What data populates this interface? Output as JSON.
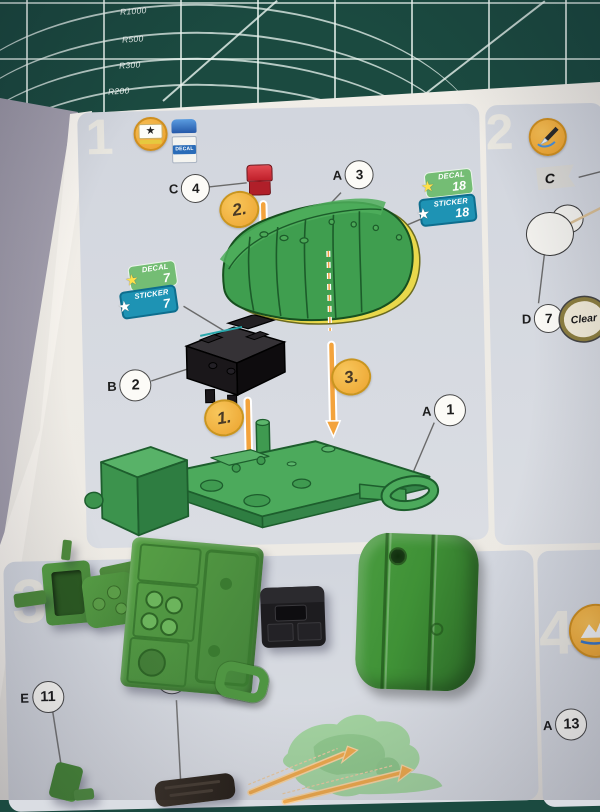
{
  "mat": {
    "labels": [
      "R1000",
      "R500",
      "R300",
      "R200"
    ]
  },
  "icons": {
    "star": "★"
  },
  "panels": {
    "p1": "1",
    "p2": "2",
    "p3": "3",
    "p4": "4"
  },
  "step1": {
    "bottle_label": "DECAL"
  },
  "step2": {
    "flag_label": "C",
    "paint_label": "Clear"
  },
  "actions": {
    "a1": "1.",
    "a2": "2.",
    "a3": "3."
  },
  "callouts": {
    "c4": {
      "letter": "C",
      "number": "4"
    },
    "a3": {
      "letter": "A",
      "number": "3"
    },
    "b2": {
      "letter": "B",
      "number": "2"
    },
    "a1": {
      "letter": "A",
      "number": "1"
    },
    "d7": {
      "letter": "D",
      "number": "7"
    },
    "e11": {
      "letter": "E",
      "number": "11"
    },
    "b10": {
      "letter": "B",
      "number": "10"
    },
    "a13": {
      "letter": "A",
      "number": "13"
    }
  },
  "badges": {
    "decal7": {
      "type": "DECAL",
      "number": "7"
    },
    "sticker7": {
      "type": "STICKER",
      "number": "7"
    },
    "decal18": {
      "type": "DECAL",
      "number": "18"
    },
    "sticker18": {
      "type": "STICKER",
      "number": "18"
    }
  },
  "colors": {
    "mat_green": "#1b4a40",
    "panel_gray": "#d6d9e0",
    "step_orange": "#f2ae3c",
    "arrow_orange": "#f3a33c",
    "decal_green": "#74bd74",
    "sticker_teal": "#1e93b4",
    "part_green": "#3f9e4f",
    "trim_yellow": "#e9d84b",
    "cap_red": "#d0242f"
  }
}
